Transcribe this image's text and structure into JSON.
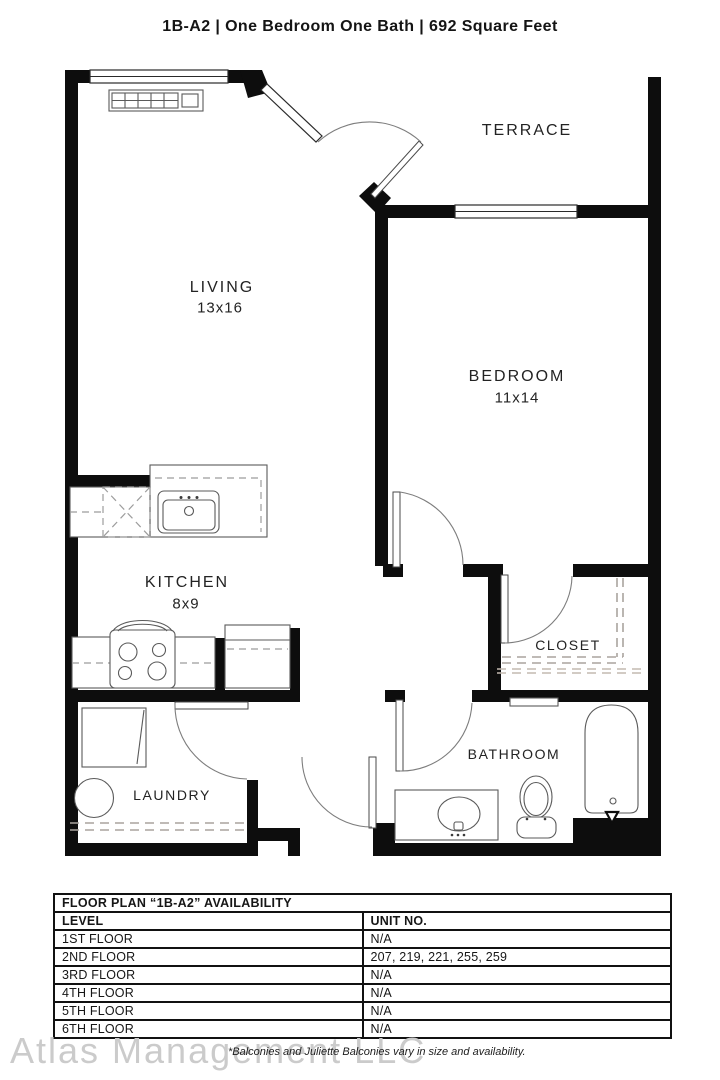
{
  "title": "1B-A2  | One Bedroom One Bath |  692 Square Feet",
  "plan": {
    "rooms": {
      "terrace": {
        "name": "TERRACE"
      },
      "living": {
        "name": "LIVING",
        "dims": "13x16"
      },
      "bedroom": {
        "name": "BEDROOM",
        "dims": "11x14"
      },
      "kitchen": {
        "name": "KITCHEN",
        "dims": "8x9"
      },
      "closet": {
        "name": "CLOSET"
      },
      "laundry": {
        "name": "LAUNDRY"
      },
      "bathroom": {
        "name": "BATHROOM"
      }
    }
  },
  "availability_table": {
    "title": "FLOOR PLAN “1B-A2” AVAILABILITY",
    "columns": {
      "level": "LEVEL",
      "unit": "UNIT NO."
    },
    "rows": [
      {
        "level": "1ST FLOOR",
        "units": "N/A"
      },
      {
        "level": "2ND FLOOR",
        "units": "207, 219, 221, 255, 259"
      },
      {
        "level": "3RD FLOOR",
        "units": "N/A"
      },
      {
        "level": "4TH FLOOR",
        "units": "N/A"
      },
      {
        "level": "5TH FLOOR",
        "units": "N/A"
      },
      {
        "level": "6TH FLOOR",
        "units": "N/A"
      }
    ]
  },
  "footer": {
    "watermark": "Atlas Management LLC",
    "disclaimer": "*Balconies and Juliette Balconies vary in size and availability."
  },
  "colors": {
    "wall": "#0d0d0d",
    "dashed": "#aaa49e",
    "watermark": "#cbcbcb"
  }
}
